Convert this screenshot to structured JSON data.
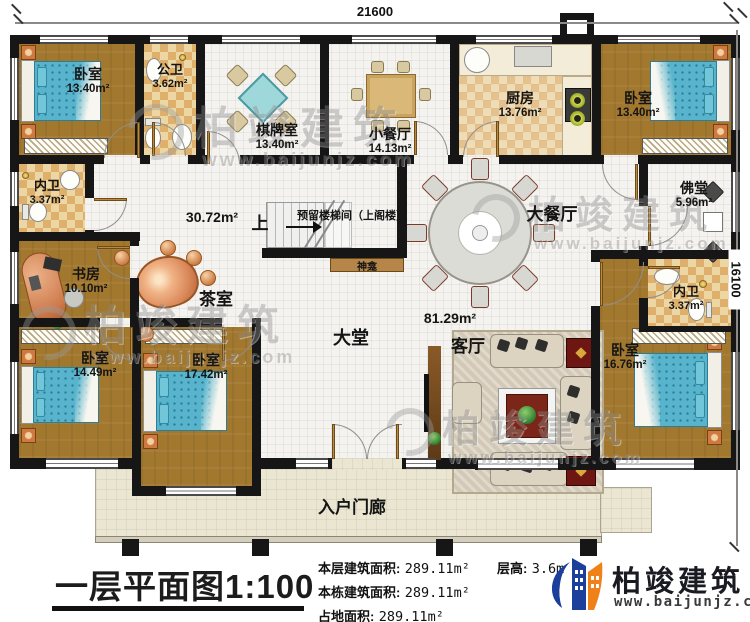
{
  "dimensions": {
    "top": "21600",
    "right": "16100"
  },
  "rooms": {
    "bedroom_top_left": {
      "name": "卧室",
      "area": "13.40m²"
    },
    "public_bathroom": {
      "name": "公卫",
      "area": "3.62m²"
    },
    "mahjong_room": {
      "name": "棋牌室",
      "area": "13.40m²"
    },
    "small_dining_room": {
      "name": "小餐厅",
      "area": "14.13m²"
    },
    "kitchen": {
      "name": "厨房",
      "area": "13.76m²"
    },
    "bedroom_top_right": {
      "name": "卧室",
      "area": "13.40m²"
    },
    "ensuite_left": {
      "name": "内卫",
      "area": "3.37m²"
    },
    "study": {
      "name": "书房",
      "area": "10.10m²"
    },
    "tea_room": {
      "name": "茶室"
    },
    "hall_area_label": "30.72m²",
    "stair_well": {
      "label": "预留楼梯间（上阁楼）",
      "direction": "上"
    },
    "shrine": {
      "name": "神龛"
    },
    "grand_dining_room": {
      "name": "大餐厅"
    },
    "buddha_hall": {
      "name": "佛堂",
      "area": "5.96m²"
    },
    "ensuite_right": {
      "name": "内卫",
      "area": "3.37m²"
    },
    "lobby": {
      "name": "大堂"
    },
    "living_area_label": "81.29m²",
    "living_room": {
      "name": "客厅"
    },
    "bedroom_bottom_left": {
      "name": "卧室",
      "area": "14.49m²"
    },
    "bedroom_bottom_mid": {
      "name": "卧室",
      "area": "17.42m²"
    },
    "bedroom_bottom_right": {
      "name": "卧室",
      "area": "16.76m²"
    },
    "entry_porch": {
      "name": "入户门廊"
    }
  },
  "title_block": {
    "title": "一层平面图1:100",
    "stats": [
      {
        "label": "本层建筑面积:",
        "value": "289.11m²"
      },
      {
        "label": "本栋建筑面积:",
        "value": "289.11m²"
      },
      {
        "label": "占地面积:",
        "value": "289.11m²"
      }
    ],
    "floor_height": {
      "label": "层高:",
      "value": "3.6m"
    }
  },
  "brand": {
    "name": "柏竣建筑",
    "url": "www.baijunjz.com"
  },
  "watermark": {
    "name": "柏竣建筑",
    "url": "www.baijunjz.com"
  },
  "colors": {
    "wall": "#161616",
    "brand_blue": "#1c3f9c",
    "accent_orange": "#f08119",
    "floor_wood": "#a2782f",
    "mattress": "#58b4cd"
  }
}
